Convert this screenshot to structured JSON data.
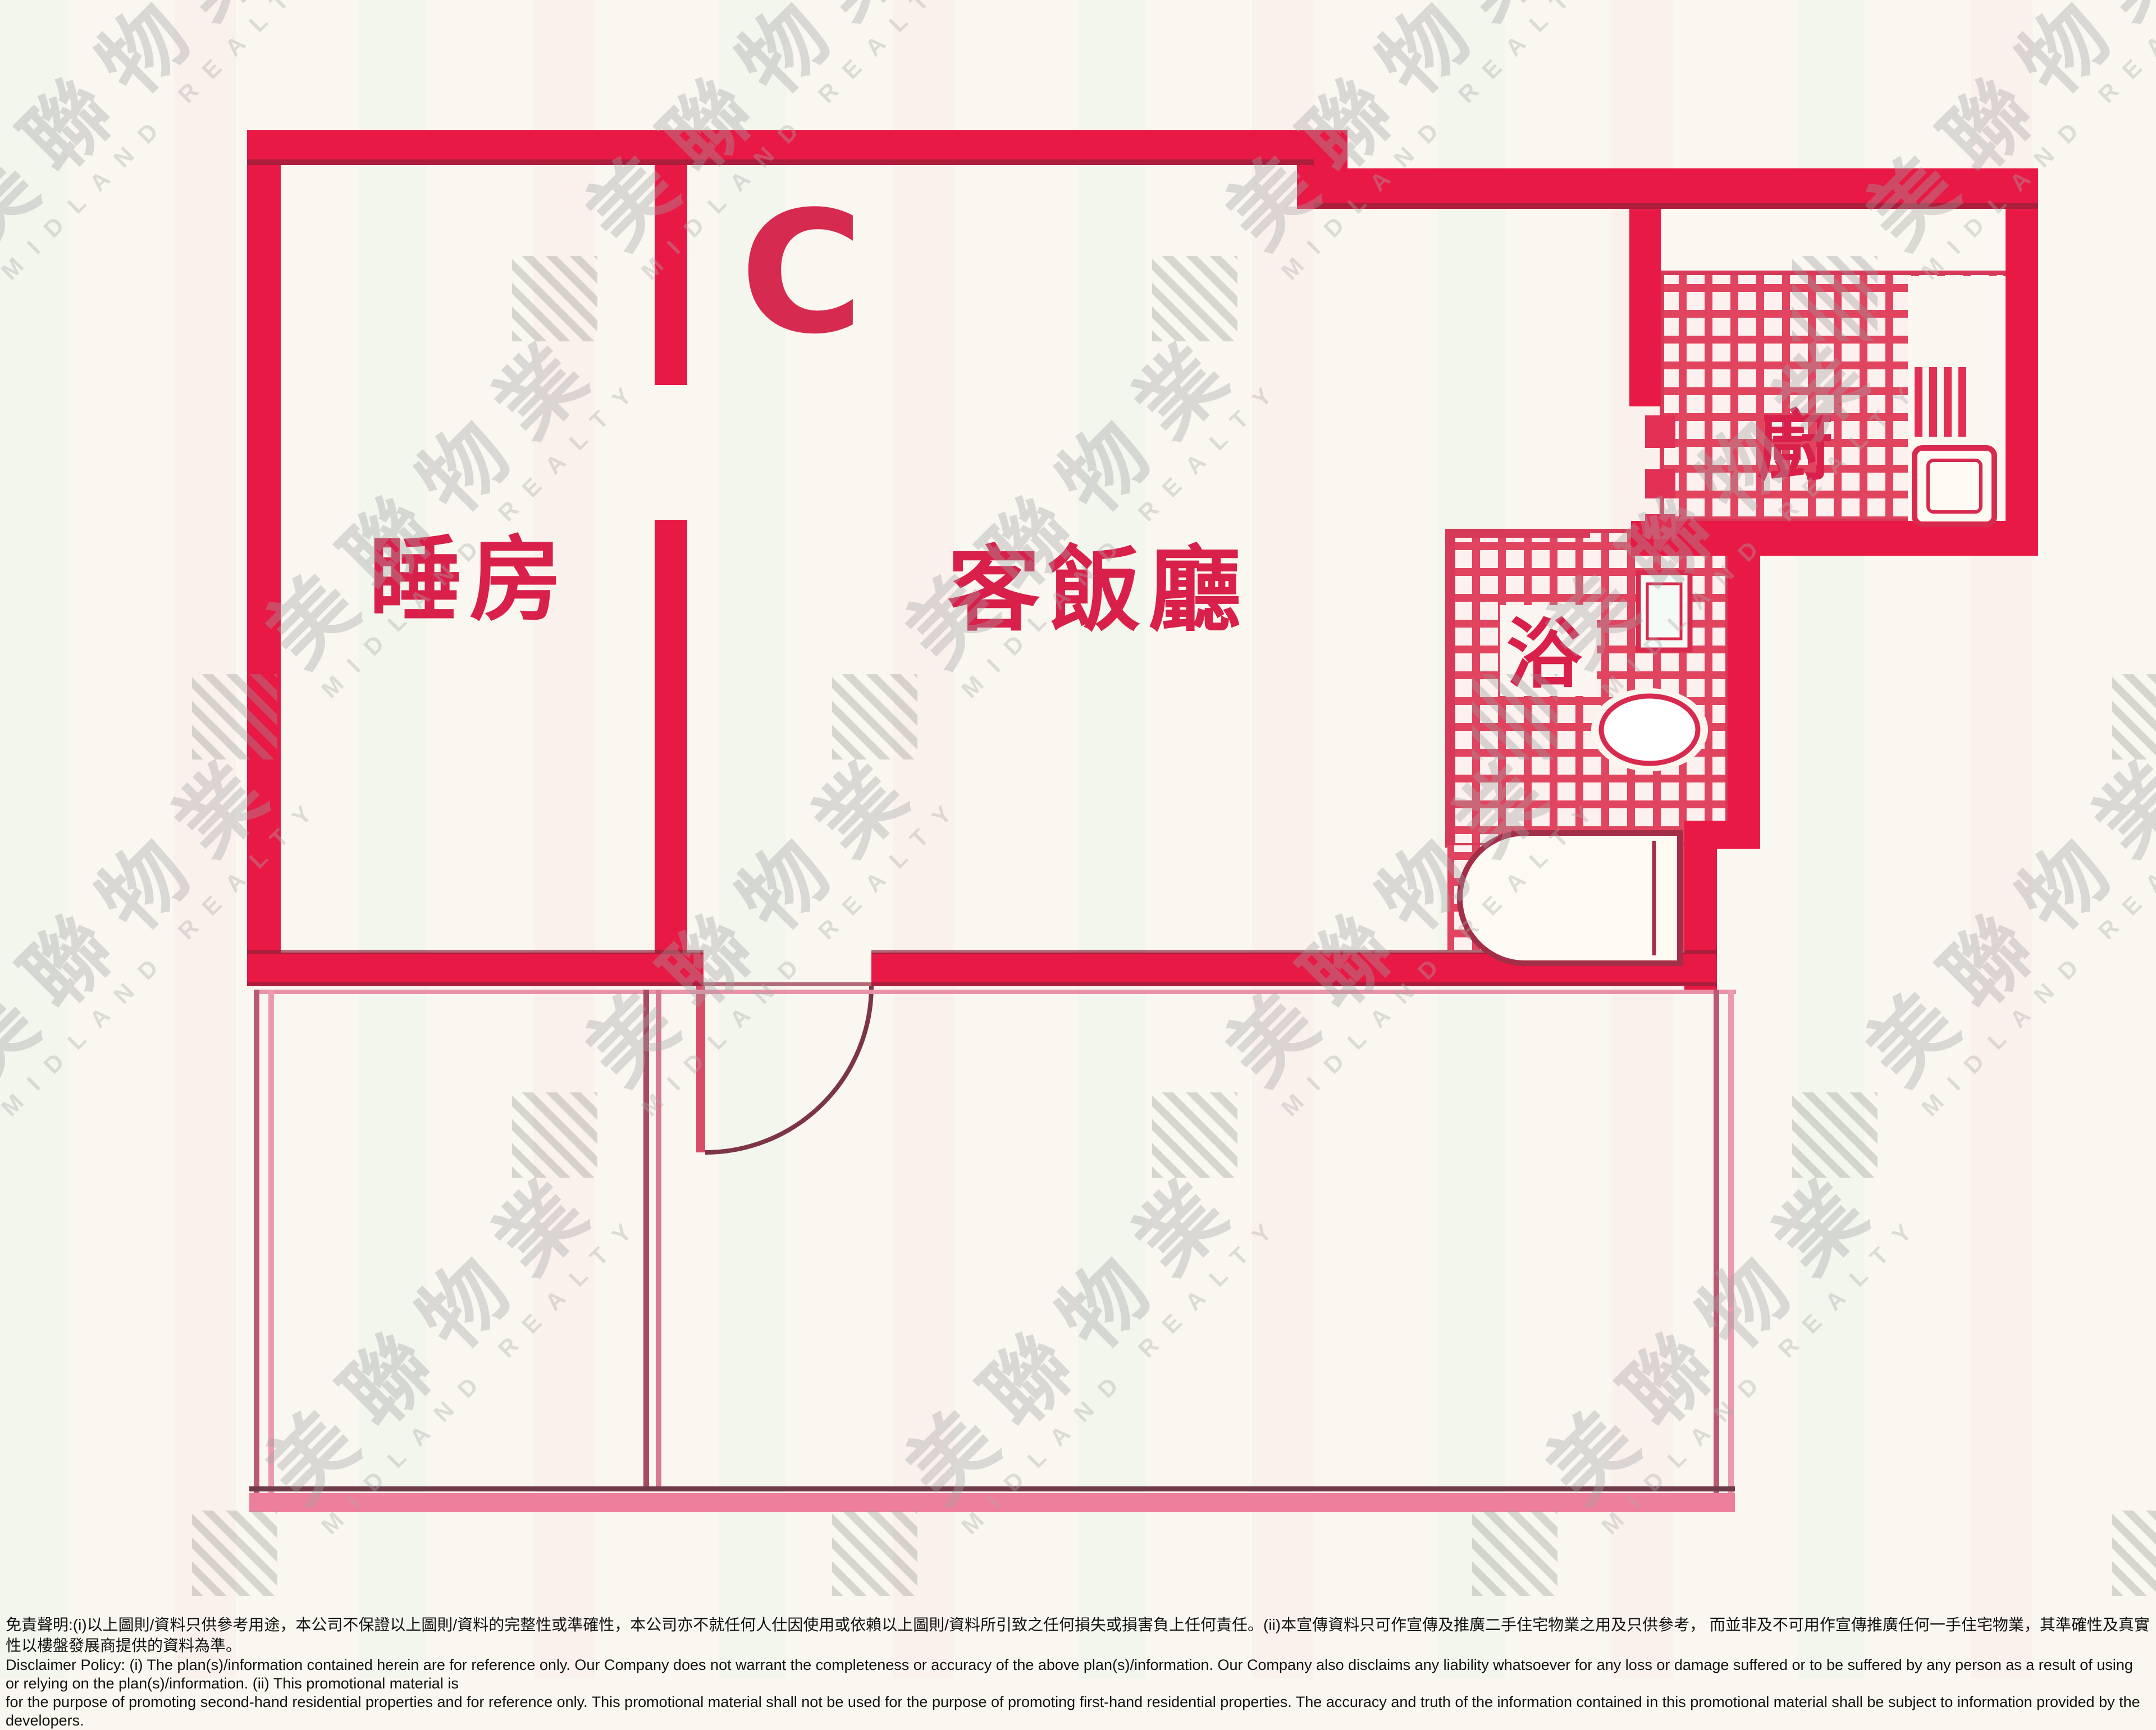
{
  "floorplan": {
    "unit_label": "C",
    "rooms": [
      {
        "id": "bedroom",
        "label": "睡房"
      },
      {
        "id": "living-dining",
        "label": "客飯廳"
      },
      {
        "id": "bathroom",
        "label": "浴"
      },
      {
        "id": "kitchen",
        "label": "廚"
      }
    ],
    "colors": {
      "wall_red": "#e81945",
      "wall_dark_edge": "#8e2138",
      "tile_line_red": "#e0445f",
      "label_red": "#d8204a",
      "terrace_pink": "#ee7f9b",
      "paper_cream": "#faf7f0",
      "watermark_gray": "#a3a3a3"
    }
  },
  "watermark": {
    "cjk": "美聯物業",
    "latin": "MIDLAND REALTY"
  },
  "disclaimer": {
    "zh": "免責聲明:(i)以上圖則/資料只供參考用途，本公司不保證以上圖則/資料的完整性或準確性，本公司亦不就任何人仕因使用或依賴以上圖則/資料所引致之任何損失或損害負上任何責任。(ii)本宣傳資料只可作宣傳及推廣二手住宅物業之用及只供參考， 而並非及不可用作宣傳推廣任何一手住宅物業，其準確性及真實性以樓盤發展商提供的資料為準。",
    "en_line1": "Disclaimer Policy: (i) The plan(s)/information contained herein are for reference only. Our Company does not warrant the completeness or accuracy of the above plan(s)/information. Our Company also disclaims any liability whatsoever for any loss or damage suffered or to be suffered by any person as a result of using or relying on the plan(s)/information. (ii) This promotional material is",
    "en_line2": "for the purpose of promoting second-hand residential properties and for reference only. This promotional material shall not be used for the purpose of promoting first-hand residential properties. The accuracy and truth of the information contained in this promotional material shall be subject to information provided by the developers."
  }
}
